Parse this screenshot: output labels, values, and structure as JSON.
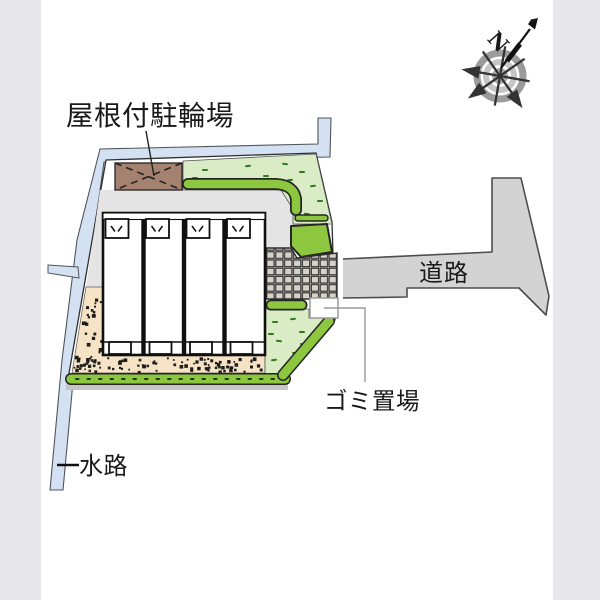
{
  "labels": {
    "bicycle_parking": "屋根付駐輪場",
    "road": "道路",
    "garbage_area": "ゴミ置場",
    "waterway": "水路",
    "compass_north": "N"
  },
  "site": {
    "units_count": 4,
    "areas": [
      "covered-bicycle-parking",
      "four-unit-building",
      "tiled-entrance",
      "garbage-station",
      "road",
      "waterway",
      "hedge-planting",
      "lawn",
      "gravel-yard"
    ]
  },
  "colors": {
    "background": "#ffffff",
    "edge_band": "#e7e7e9",
    "water": "#d4e1f2",
    "water_outline": "#50555c",
    "site_outline": "#2f2f2f",
    "apron": "#e4e4e4",
    "gravel": "#f6e3c6",
    "gravel_dot": "#1d1d1d",
    "grass": "#daecc5",
    "grass_dash": "#2f7a1d",
    "hedge": "#8dc63f",
    "hedge_outline": "#252525",
    "brown": "#a58270",
    "tile": "#cdc9c1",
    "tile_line": "#2e2e2e",
    "road": "#d3d3d3",
    "road_outline": "#4d4d4d",
    "building_wall": "#101010",
    "text": "#1a1a1a",
    "leader_gray": "#9a9a9a",
    "strip_gray": "#c6c6c6",
    "compass_ring_outer": "#9b9b9b",
    "compass_ring_mid": "#c6c6c6",
    "compass_ring_inner": "#a8a8a8",
    "compass_spoke": "#333333"
  },
  "decor": {
    "grass_dashes_top": [
      [
        205,
        170,
        0
      ],
      [
        227,
        181,
        8
      ],
      [
        248,
        166,
        -6
      ],
      [
        266,
        176,
        0
      ],
      [
        285,
        164,
        6
      ],
      [
        302,
        172,
        0
      ],
      [
        313,
        186,
        -8
      ],
      [
        320,
        201,
        0
      ],
      [
        307,
        214,
        6
      ],
      [
        290,
        180,
        -5
      ],
      [
        215,
        186,
        0
      ],
      [
        240,
        184,
        5
      ],
      [
        195,
        178,
        0
      ]
    ],
    "grass_dashes_bottom": [
      [
        275,
        322,
        0
      ],
      [
        293,
        319,
        -6
      ],
      [
        302,
        332,
        0
      ],
      [
        279,
        341,
        6
      ],
      [
        295,
        353,
        0
      ],
      [
        274,
        360,
        -6
      ],
      [
        287,
        367,
        5
      ],
      [
        303,
        344,
        0
      ],
      [
        271,
        334,
        0
      ]
    ]
  }
}
